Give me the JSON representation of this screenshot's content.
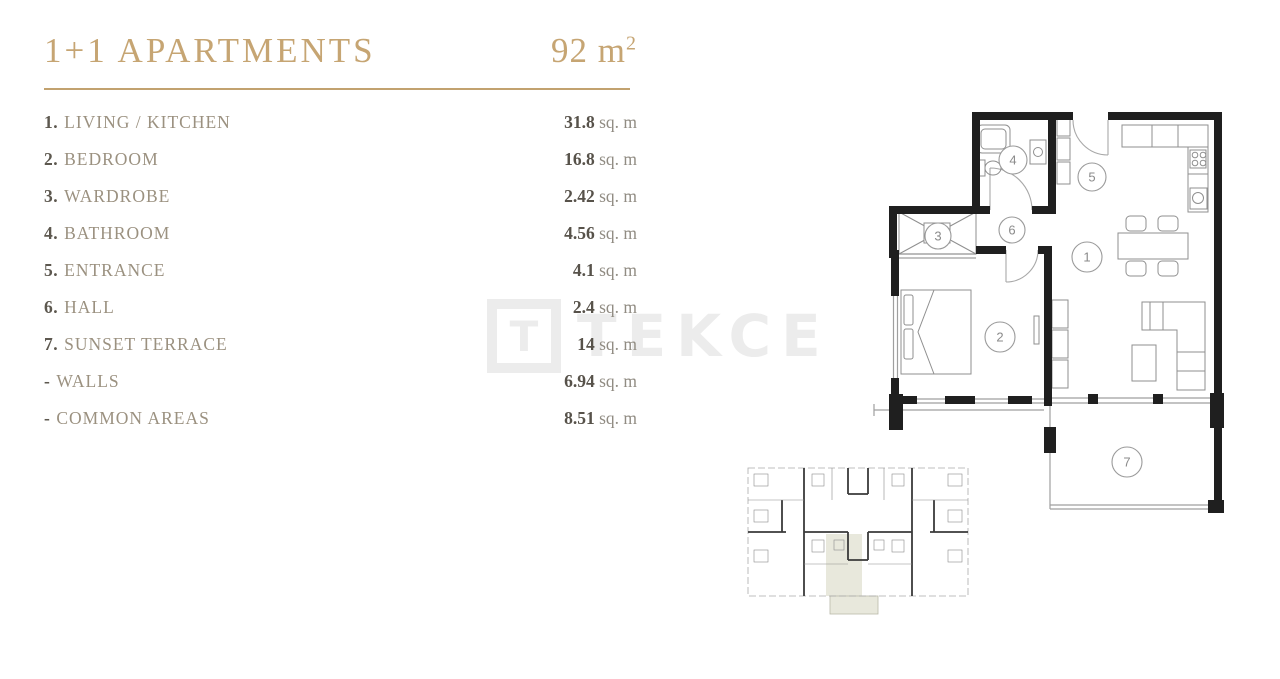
{
  "header": {
    "title": "1+1 APARTMENTS",
    "area_value": "92 m",
    "area_sup": "2"
  },
  "legend": {
    "rows": [
      {
        "num": "1.",
        "name": "LIVING / KITCHEN",
        "value": "31.8",
        "unit": " sq. m"
      },
      {
        "num": "2.",
        "name": "BEDROOM",
        "value": "16.8",
        "unit": " sq. m"
      },
      {
        "num": "3.",
        "name": "WARDROBE",
        "value": "2.42",
        "unit": " sq. m"
      },
      {
        "num": "4.",
        "name": "BATHROOM",
        "value": "4.56",
        "unit": " sq. m"
      },
      {
        "num": "5.",
        "name": "ENTRANCE",
        "value": "4.1",
        "unit": " sq. m"
      },
      {
        "num": "6.",
        "name": "HALL",
        "value": "2.4",
        "unit": " sq. m"
      },
      {
        "num": "7.",
        "name": "SUNSET TERRACE",
        "value": "14",
        "unit": " sq. m"
      },
      {
        "num": "-",
        "name": "WALLS",
        "value": "6.94",
        "unit": " sq. m"
      },
      {
        "num": "-",
        "name": "COMMON AREAS",
        "value": "8.51",
        "unit": " sq. m"
      }
    ]
  },
  "watermark": {
    "logo_letter": "T",
    "text": "TEKCE"
  },
  "floorplan": {
    "labels": {
      "living": "1",
      "bedroom": "2",
      "wardrobe": "3",
      "bathroom": "4",
      "entrance": "5",
      "hall": "6",
      "terrace": "7"
    }
  },
  "colors": {
    "accent_gold": "#c6a573",
    "legend_name": "#9b9180",
    "value_dark": "#57524a",
    "wall_black": "#1f1f1f",
    "highlight_unit": "#e8e8dc",
    "watermark_gray": "#ececec"
  }
}
